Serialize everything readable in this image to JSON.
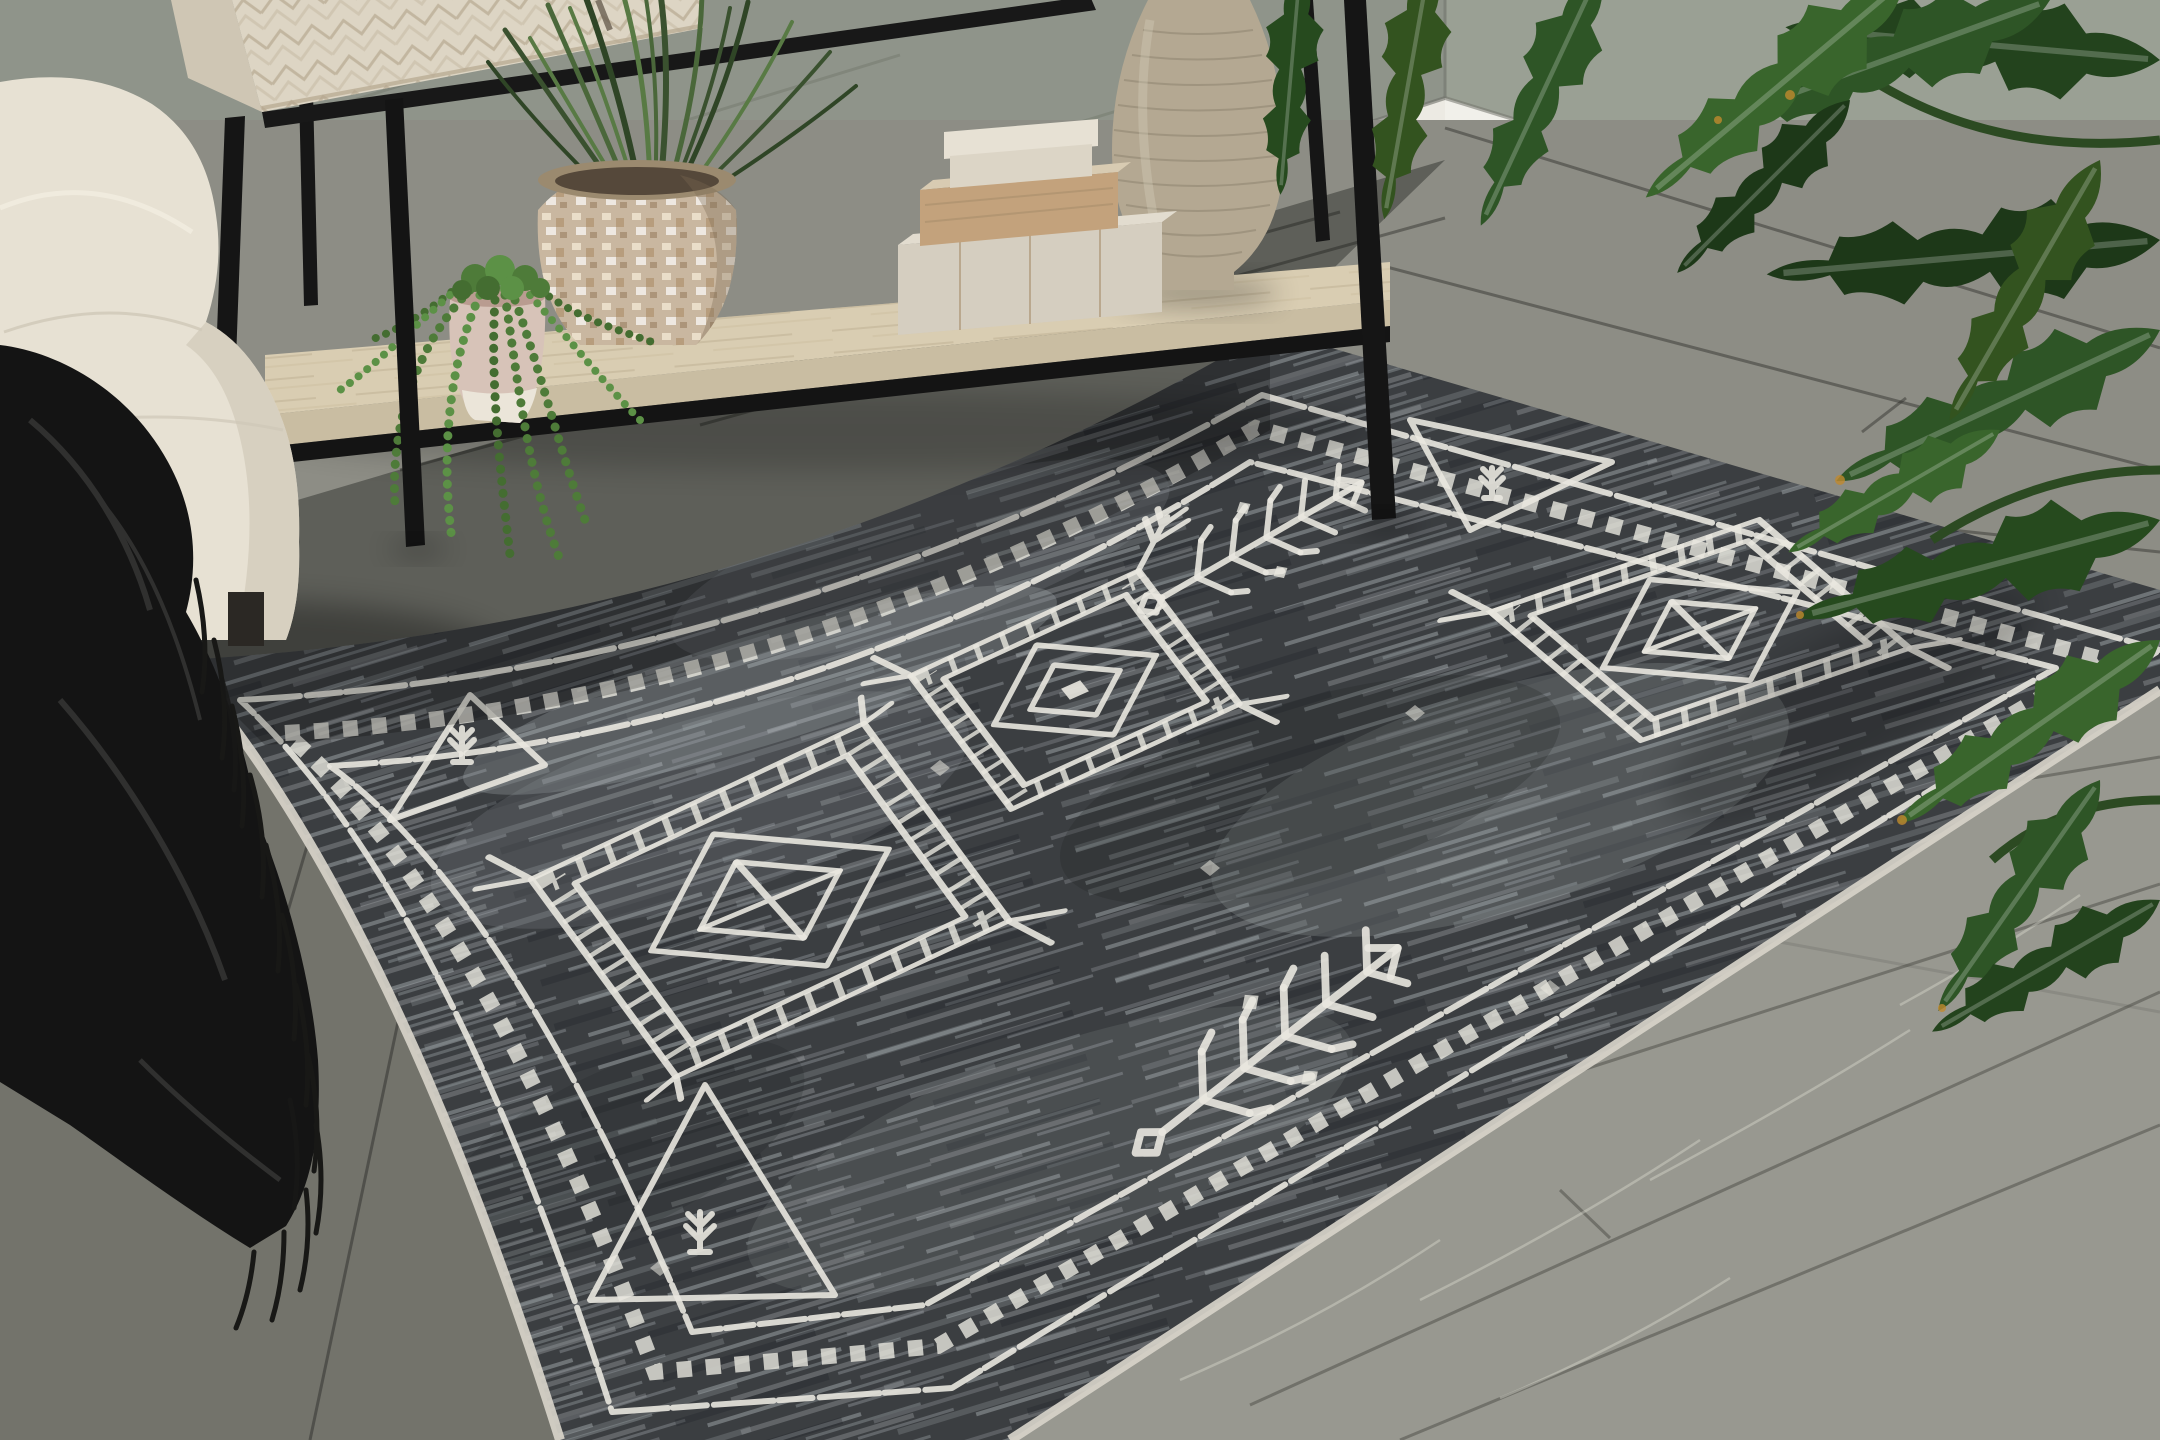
{
  "scene": {
    "description": "Living room corner with a charcoal distressed tribal-pattern area rug on gray wood plank flooring, whitewashed console table with decor, cream sofa with black fringed throw, and a philodendron plant",
    "objects": {
      "rug": {
        "label": "charcoal tribal area rug",
        "field_color": "#3b3e41",
        "motif_color": "#e9e7df",
        "binding_color": "#d7d2c9",
        "medallion_count": 3,
        "corner_triangle_count": 3,
        "branch_motif_count": 2,
        "border_style": "checkered diamond band between double white lines"
      },
      "floor": {
        "label": "gray wood plank floor",
        "color": "#8d8d85"
      },
      "wall": {
        "label": "gray-green wall with white baseboard",
        "left_color": "#8f948a",
        "right_color": "#9aa094",
        "baseboard_color": "#eceae3"
      },
      "console_table": {
        "label": "whitewashed console table with black metal frame",
        "cabinet_color": "#ddd5c4",
        "cabinet_side_color": "#cfc6b4",
        "metal_color": "#161616",
        "shelf_color": "#d9cdb2",
        "shelf_edge_color": "#c9bda2"
      },
      "decor": {
        "vase_label": "tall ribbed stone vase",
        "vase_color": "#b4a892",
        "boxes_label": "stack of three linen and wood boxes",
        "box_linen_color": "#d5cec0",
        "box_wood_color": "#c3a27c",
        "mosaic_pot_label": "mosaic mother-of-pearl pot with grass plant",
        "mosaic_pot_color": "#c9b7a0",
        "grass_color": "#4a673a",
        "succulent_label": "string of pearls in blush pot",
        "succulent_color": "#4e7b39",
        "succulent_pot_color": "#d7c3b8"
      },
      "sofa": {
        "label": "cream upholstered sofa",
        "color": "#e7e1d3"
      },
      "throw": {
        "label": "black fringed throw blanket",
        "color": "#141414"
      },
      "pillow": {
        "label": "black and white speckled pillow",
        "color": "#2b2b27"
      },
      "plant": {
        "label": "philodendron with serrated leaves",
        "leaf_color": "#2e5526",
        "stem_color": "#2c4a22"
      }
    }
  }
}
